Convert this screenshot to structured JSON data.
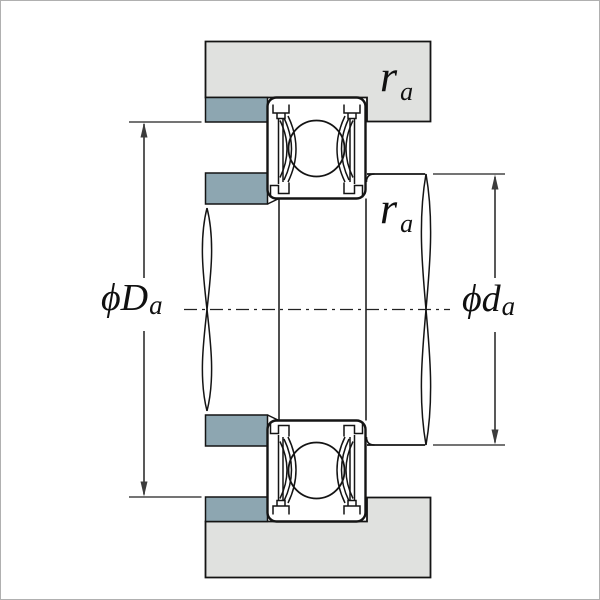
{
  "figure": {
    "labels": {
      "housing_abutment_diameter": {
        "prefix": "ϕD",
        "sub": "a"
      },
      "shaft_abutment_diameter": {
        "prefix": "ϕd",
        "sub": "a"
      },
      "housing_fillet_radius": {
        "prefix": "r",
        "sub": "a"
      },
      "shaft_fillet_radius": {
        "prefix": "r",
        "sub": "a"
      }
    },
    "colors": {
      "background": "#ffffff",
      "housing": "#e0e1df",
      "spacer": "#8da6b1",
      "line": "#141414",
      "dim": "#3c3c3c",
      "border": "#b0b0b0"
    }
  }
}
